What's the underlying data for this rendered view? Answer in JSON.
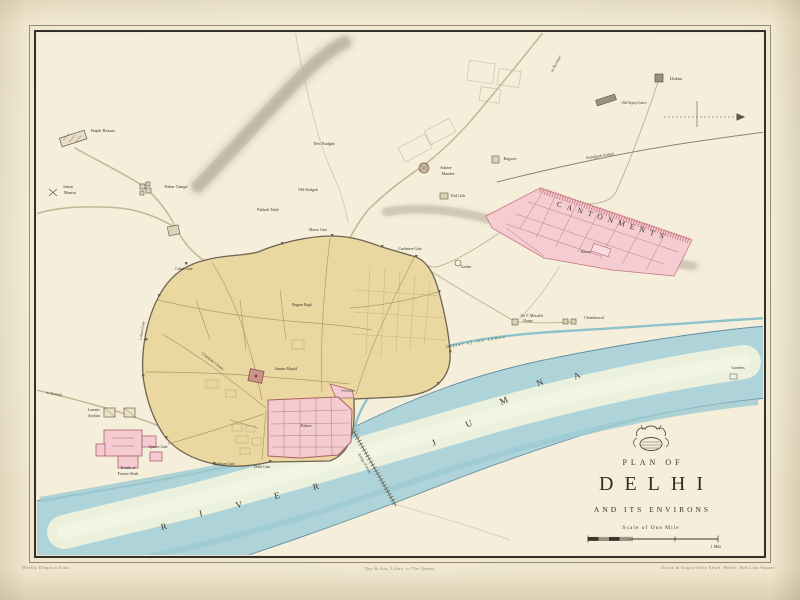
{
  "title": {
    "plan_of": "PLAN OF",
    "name": "DELHI",
    "subtitle": "AND ITS ENVIRONS",
    "scale_label": "Scale of One Mile"
  },
  "imprint": {
    "left": "Weekly Dispatch Atlas",
    "center": "Day & Son, Lithrs. to The Queen.",
    "right": "Drawn & Engraved by Edwd. Weller, Red Lion Square."
  },
  "colors": {
    "paper": "#efe6cd",
    "map_field": "#f5eedb",
    "city_fill": "#ebd7a0",
    "palace_pink": "#f3cbd0",
    "pink_stroke": "#ad5f68",
    "river": "#aed4da",
    "river_shallow": "#eef2dc",
    "ridge_grey": "#aaa291",
    "road": "#c5b894",
    "ink": "#3c342a"
  },
  "labels": [
    {
      "t": "Rajah Bazaar",
      "x": 103,
      "y": 131,
      "s": 4.5
    },
    {
      "t": "Pahar Gunge",
      "x": 176,
      "y": 187,
      "s": 4.5
    },
    {
      "t": "Juntur",
      "x": 68,
      "y": 187,
      "s": 4
    },
    {
      "t": "Muntur",
      "x": 70,
      "y": 193,
      "s": 4
    },
    {
      "t": "New Budgah",
      "x": 324,
      "y": 144,
      "s": 4
    },
    {
      "t": "Old Budgah",
      "x": 308,
      "y": 190,
      "s": 4
    },
    {
      "t": "Pukkah Talab",
      "x": 268,
      "y": 210,
      "s": 4
    },
    {
      "t": "Subzee",
      "x": 446,
      "y": 168,
      "s": 4
    },
    {
      "t": "Mundee",
      "x": 448,
      "y": 174,
      "s": 4
    },
    {
      "t": "Bujpore",
      "x": 510,
      "y": 159,
      "s": 4
    },
    {
      "t": "Eed Gah",
      "x": 458,
      "y": 196,
      "s": 4
    },
    {
      "t": "Dukka",
      "x": 676,
      "y": 79,
      "s": 4.5
    },
    {
      "t": "Old Sepoy Lines",
      "x": 634,
      "y": 104,
      "s": 3.8,
      "i": true
    },
    {
      "t": "CANTONMENTS",
      "x": 613,
      "y": 221,
      "s": 7.5,
      "rot": 17,
      "ls": 5.5
    },
    {
      "t": "Bazaar",
      "x": 586,
      "y": 253,
      "s": 3.6
    },
    {
      "t": "Garden",
      "x": 466,
      "y": 268,
      "s": 3.6
    },
    {
      "t": "to Kurnaul",
      "x": 556,
      "y": 64,
      "s": 4,
      "rot": -62,
      "i": true
    },
    {
      "t": "Najufgurh Kullah",
      "x": 600,
      "y": 156,
      "s": 4,
      "rot": -8,
      "i": true
    },
    {
      "t": "Sir T. Metcalfe",
      "x": 532,
      "y": 317,
      "s": 3.8
    },
    {
      "t": "House",
      "x": 528,
      "y": 322,
      "s": 3.8
    },
    {
      "t": "Chundrawul",
      "x": 594,
      "y": 318,
      "s": 4
    },
    {
      "t": "Gardens",
      "x": 738,
      "y": 368,
      "s": 4
    },
    {
      "t": "Offset of the Jumna",
      "x": 476,
      "y": 342,
      "s": 4.2,
      "rot": -10,
      "i": true,
      "ls": 1.5
    },
    {
      "t": "Moree Gate",
      "x": 318,
      "y": 231,
      "s": 3.8
    },
    {
      "t": "Cashmere Gate",
      "x": 410,
      "y": 250,
      "s": 3.8
    },
    {
      "t": "Cabul Gate",
      "x": 184,
      "y": 270,
      "s": 3.8
    },
    {
      "t": "Lahore Gate",
      "x": 143,
      "y": 331,
      "s": 3.8,
      "rot": -80
    },
    {
      "t": "Ajmere Gate",
      "x": 158,
      "y": 448,
      "s": 3.8
    },
    {
      "t": "Turkman Gate",
      "x": 224,
      "y": 465,
      "s": 3.8
    },
    {
      "t": "Delhi Gate",
      "x": 262,
      "y": 468,
      "s": 3.8
    },
    {
      "t": "Chandnee Chowk",
      "x": 212,
      "y": 362,
      "s": 3.8,
      "rot": 38
    },
    {
      "t": "Begum Bagh",
      "x": 302,
      "y": 306,
      "s": 3.8
    },
    {
      "t": "Jumma Musjid",
      "x": 286,
      "y": 370,
      "s": 3.8
    },
    {
      "t": "Palace",
      "x": 306,
      "y": 426,
      "s": 4.2
    },
    {
      "t": "Selimgurh",
      "x": 348,
      "y": 391,
      "s": 3.5
    },
    {
      "t": "Lunatic",
      "x": 94,
      "y": 410,
      "s": 4
    },
    {
      "t": "Asylum",
      "x": 94,
      "y": 416,
      "s": 4
    },
    {
      "t": "Kotila of",
      "x": 128,
      "y": 468,
      "s": 4.2
    },
    {
      "t": "Feroze Shah",
      "x": 128,
      "y": 474,
      "s": 4.2
    },
    {
      "t": "to Kootub",
      "x": 54,
      "y": 394,
      "s": 4,
      "rot": 10,
      "i": true
    },
    {
      "t": "Bridge of Boats",
      "x": 364,
      "y": 464,
      "s": 3.6,
      "rot": 60
    },
    {
      "t": "R",
      "x": 164,
      "y": 527,
      "s": 9,
      "rot": -14
    },
    {
      "t": "I",
      "x": 201,
      "y": 514,
      "s": 9,
      "rot": -14
    },
    {
      "t": "V",
      "x": 239,
      "y": 505,
      "s": 9,
      "rot": -14
    },
    {
      "t": "E",
      "x": 277,
      "y": 496,
      "s": 9,
      "rot": -14
    },
    {
      "t": "R",
      "x": 316,
      "y": 487,
      "s": 9,
      "rot": -14
    },
    {
      "t": "J",
      "x": 434,
      "y": 443,
      "s": 9,
      "rot": -25
    },
    {
      "t": "U",
      "x": 469,
      "y": 424,
      "s": 9,
      "rot": -25
    },
    {
      "t": "M",
      "x": 504,
      "y": 401,
      "s": 9,
      "rot": -25
    },
    {
      "t": "N",
      "x": 540,
      "y": 383,
      "s": 9,
      "rot": -25
    },
    {
      "t": "A",
      "x": 577,
      "y": 376,
      "s": 9,
      "rot": -25
    },
    {
      "t": "1 Mile",
      "x": 716,
      "y": 547,
      "s": 4
    }
  ]
}
